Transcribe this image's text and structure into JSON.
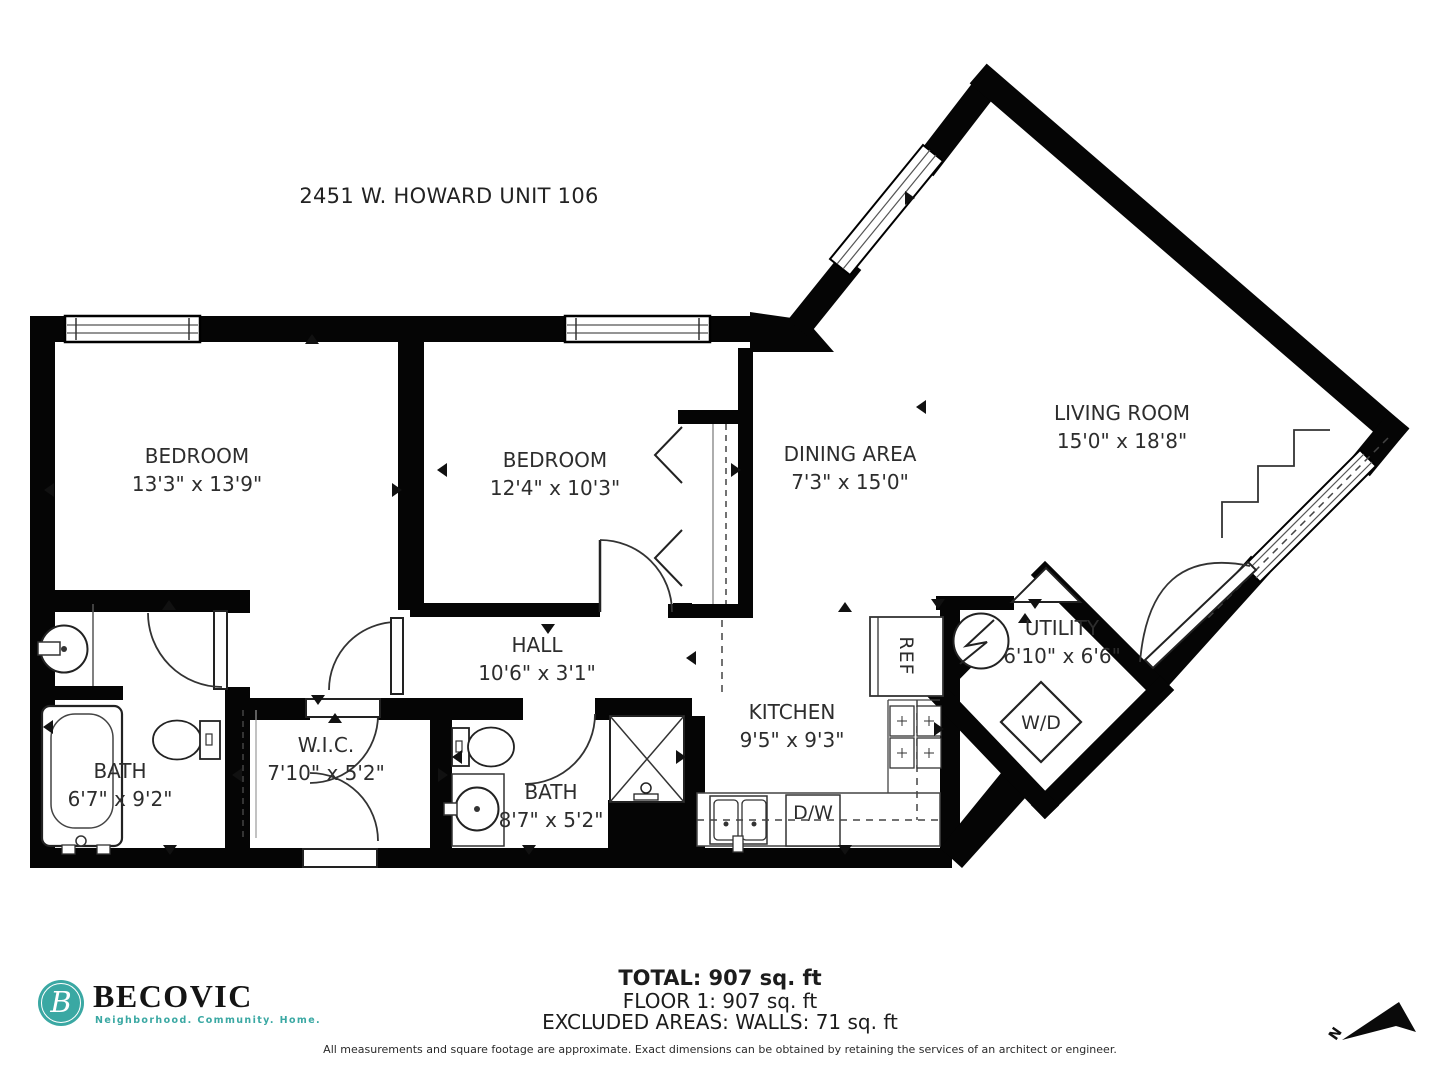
{
  "title": "2451 W. HOWARD UNIT 106",
  "rooms": [
    {
      "id": "bedroom-1",
      "name": "BEDROOM",
      "dims": "13'3\" x 13'9\""
    },
    {
      "id": "bedroom-2",
      "name": "BEDROOM",
      "dims": "12'4\" x 10'3\""
    },
    {
      "id": "dining-area",
      "name": "DINING AREA",
      "dims": "7'3\" x 15'0\""
    },
    {
      "id": "living-room",
      "name": "LIVING ROOM",
      "dims": "15'0\" x 18'8\""
    },
    {
      "id": "hall",
      "name": "HALL",
      "dims": "10'6\" x 3'1\""
    },
    {
      "id": "kitchen",
      "name": "KITCHEN",
      "dims": "9'5\" x 9'3\""
    },
    {
      "id": "utility",
      "name": "UTILITY",
      "dims": "6'10\" x 6'6\""
    },
    {
      "id": "bath-1",
      "name": "BATH",
      "dims": "6'7\" x 9'2\""
    },
    {
      "id": "wic",
      "name": "W.I.C.",
      "dims": "7'10\" x 5'2\""
    },
    {
      "id": "bath-2",
      "name": "BATH",
      "dims": "8'7\" x 5'2\""
    }
  ],
  "appliances": {
    "refrigerator": "REF",
    "washer_dryer": "W/D",
    "dishwasher": "D/W"
  },
  "summary": {
    "total": "TOTAL: 907 sq. ft",
    "floor": "FLOOR 1: 907 sq. ft",
    "excluded": "EXCLUDED AREAS: WALLS: 71 sq. ft"
  },
  "disclaimer": "All measurements and square footage are approximate. Exact dimensions can be obtained by retaining the services of an architect or engineer.",
  "logo": {
    "brand": "BECOVIC",
    "monogram": "B",
    "tagline": "Neighborhood. Community. Home.",
    "accent_color": "#3AA8A3"
  },
  "compass": {
    "north_label": "N"
  }
}
